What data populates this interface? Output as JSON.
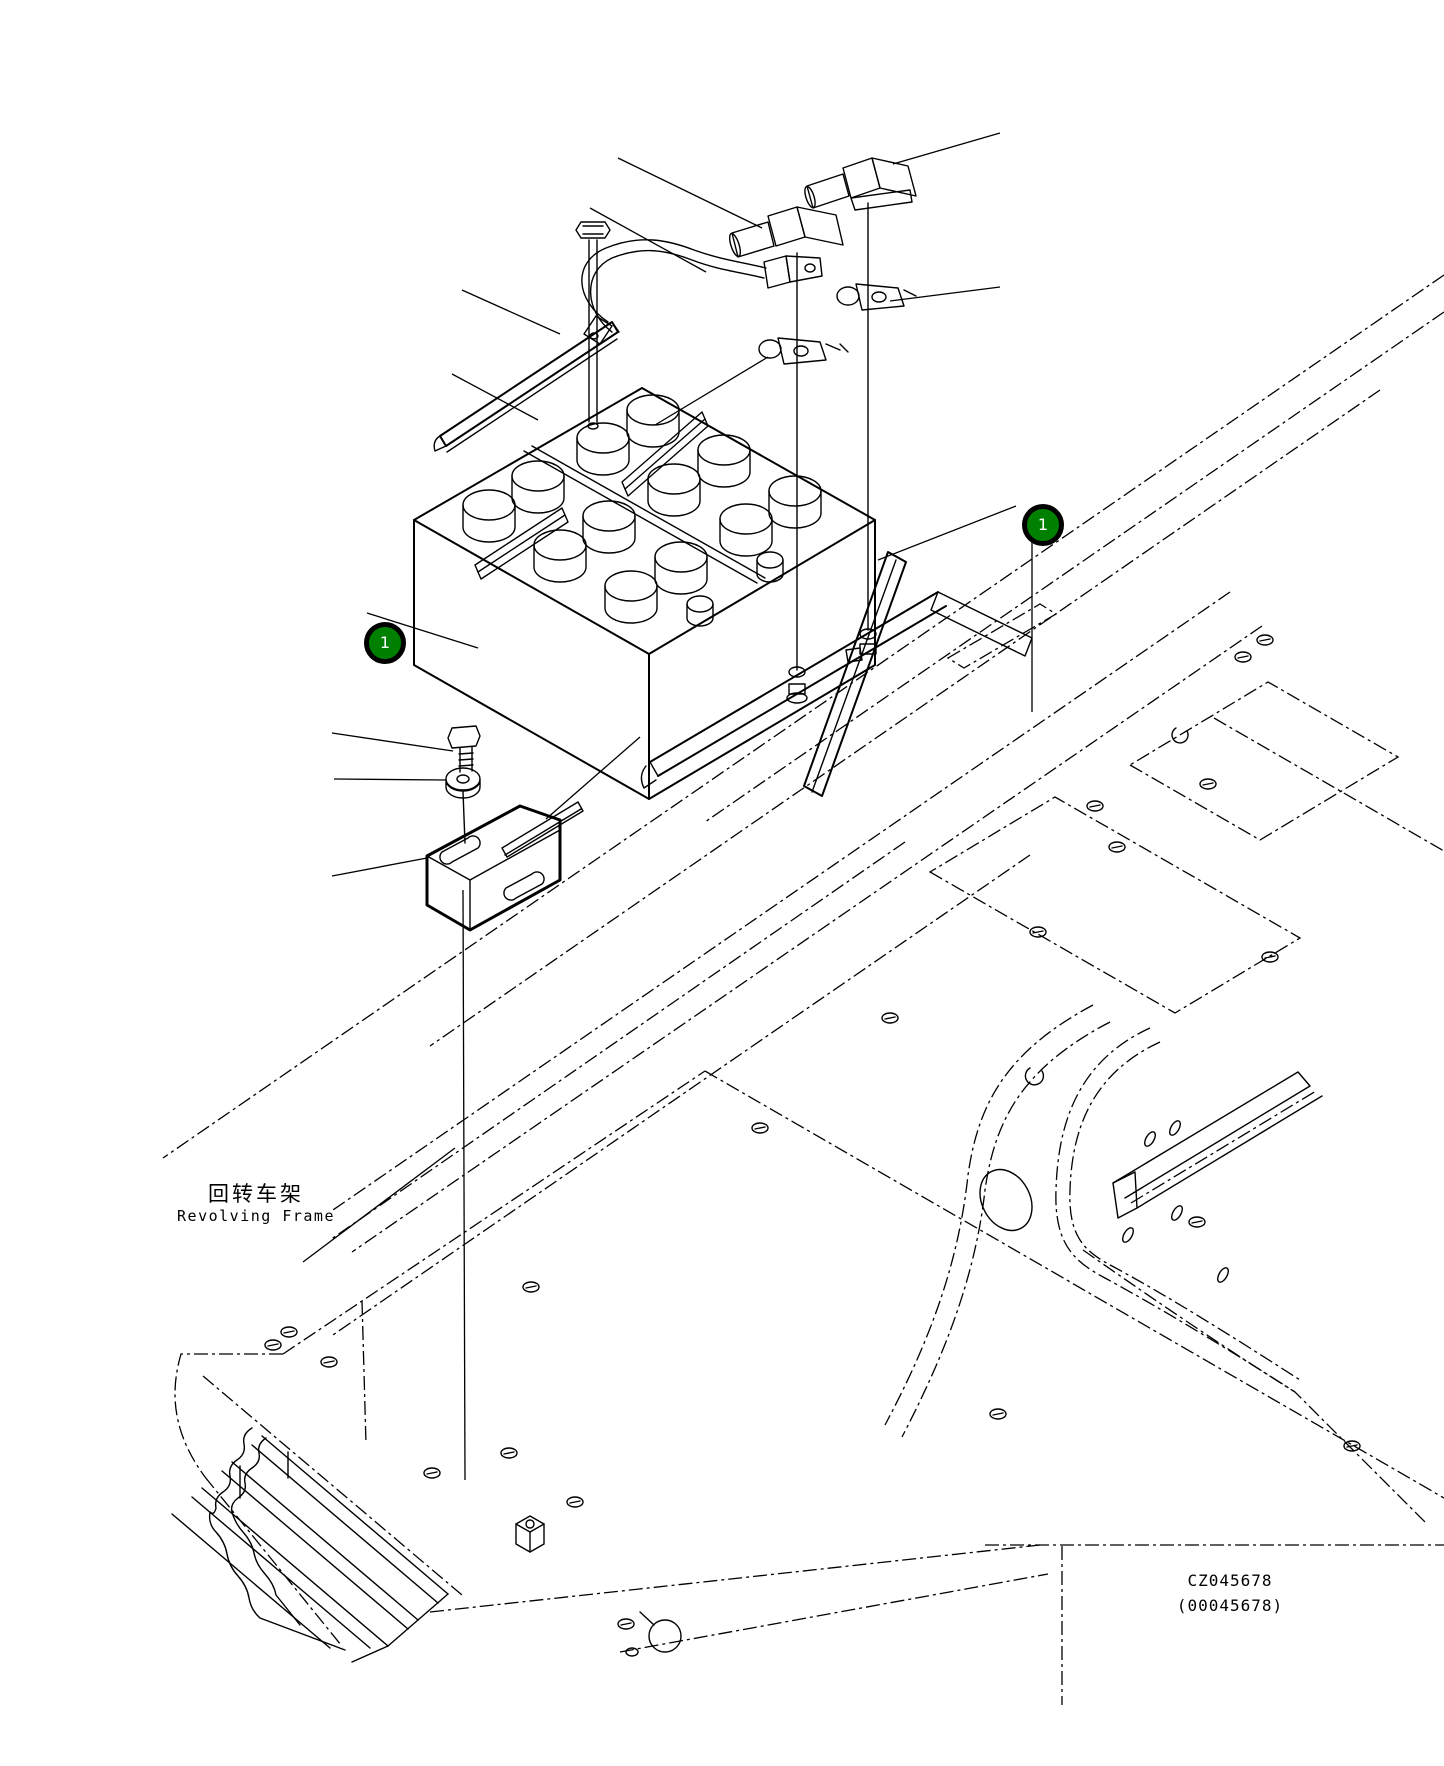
{
  "balloons": [
    {
      "number": "1"
    },
    {
      "number": "1"
    }
  ],
  "labels": {
    "frame_zh": "回转车架",
    "frame_en": "Revolving Frame"
  },
  "drawing_codes": {
    "code": "CZ045678",
    "code_alt": "(00045678)"
  },
  "colors": {
    "background": "#ffffff",
    "line": "#000000",
    "balloon_fill": "#008000",
    "balloon_ring": "#000000",
    "balloon_number": "#ffffff"
  }
}
